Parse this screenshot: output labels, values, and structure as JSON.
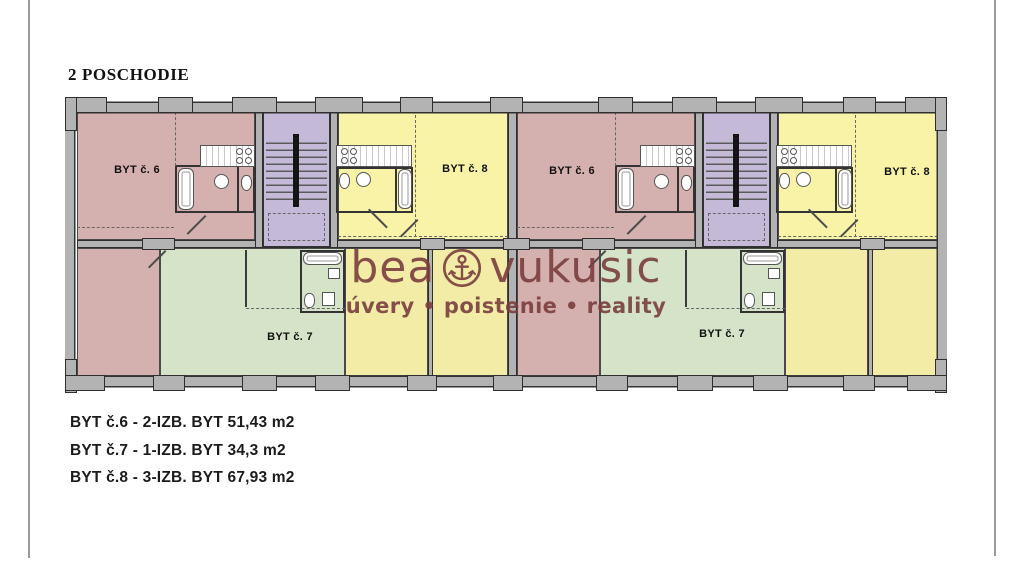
{
  "page": {
    "title": "2 POSCHODIE"
  },
  "watermark": {
    "brand_left": "bea",
    "brand_right": "vukusic",
    "tagline": "úvery • poistenie • reality",
    "color": "#7a3e3e"
  },
  "plan": {
    "room_labels": {
      "byt6": "BYT č. 6",
      "byt7": "BYT č. 7",
      "byt8": "BYT č. 8"
    },
    "colors": {
      "pink": "#d4b1ae",
      "yellow": "#f8f3a6",
      "yellow_warm": "#f3eca7",
      "green": "#d5e4c8",
      "purple": "#c4b9d6",
      "wall_gray": "#b3b3b3",
      "wall_line": "#333333"
    }
  },
  "legend": {
    "items": [
      "BYT č.6 - 2-IZB. BYT 51,43 m2",
      "BYT č.7 - 1-IZB. BYT 34,3 m2",
      "BYT č.8 - 3-IZB. BYT 67,93 m2"
    ]
  }
}
